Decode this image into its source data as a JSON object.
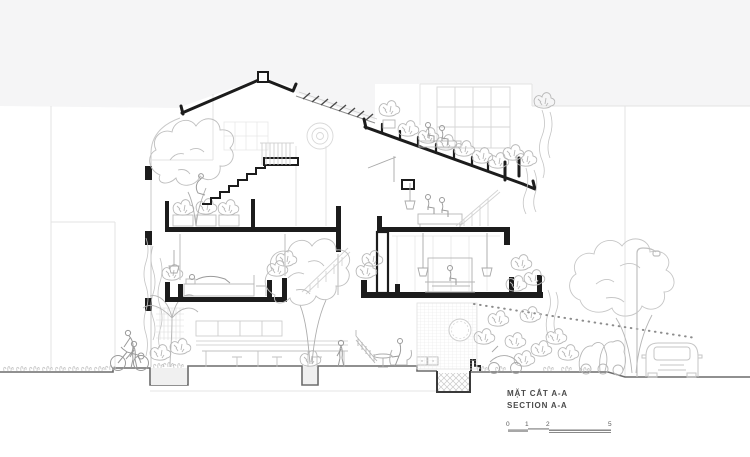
{
  "app": {
    "type": "architectural-section-drawing"
  },
  "palette": {
    "paper": "#ffffff",
    "sky": "#f5f5f6",
    "cut_line": "#1c1c1c",
    "ground_line": "#6b6b6b",
    "elevation_line": "#b5b5b5",
    "faint_line": "#dcdcdc",
    "text": "#4a4a4a"
  },
  "title_block": {
    "title_primary": "MẶT CẮT A-A",
    "title_secondary": "SECTION A-A"
  },
  "scale_bar": {
    "ticks": [
      "0",
      "1",
      "2",
      "5"
    ]
  },
  "scene": {
    "elements": [
      "gable-roof",
      "ridge-vent",
      "skylight-louvers",
      "stepped-green-roof",
      "roof-planters",
      "attic-planter",
      "stair-flight",
      "landing-railing",
      "ceiling-fan",
      "grid-window",
      "bedroom-left",
      "four-poster-bed",
      "master-bedroom",
      "pendant-lamps",
      "kitchen-counter",
      "dining-table",
      "perforated-brick-wall",
      "round-window",
      "foundation-pit",
      "sunken-planters",
      "courtyard-tree",
      "street-tree",
      "street-lamp",
      "car",
      "scooters",
      "cyclist",
      "pedestrians",
      "hanging-vines",
      "section-sightline"
    ]
  }
}
